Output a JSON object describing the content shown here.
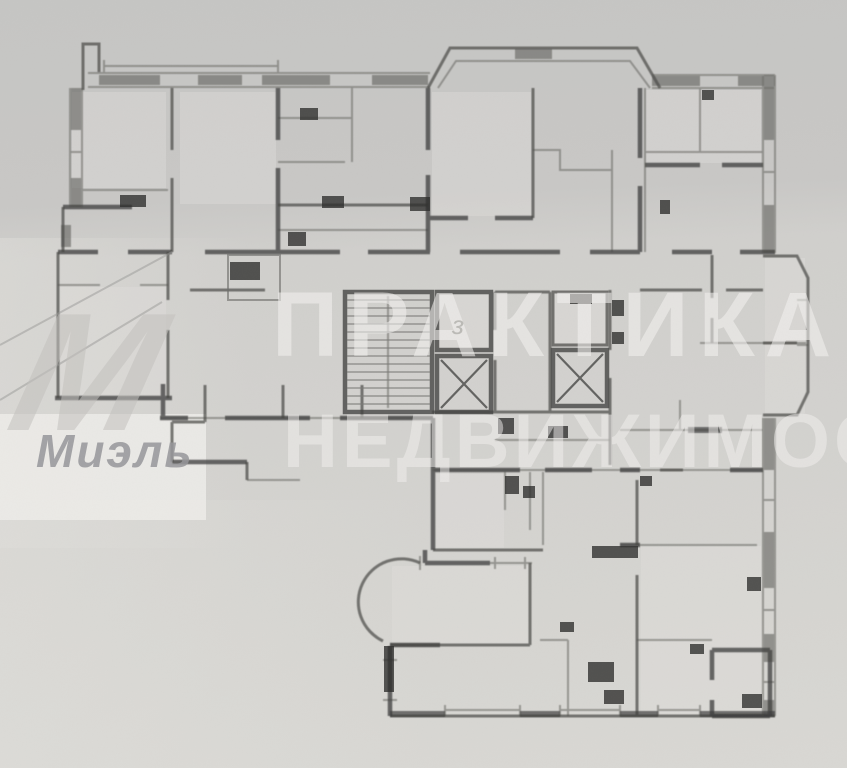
{
  "watermarks": {
    "practika": {
      "line1": "ПРАКТИКА",
      "line2": "НЕДВИЖИМОСТ",
      "color": "#f3f2ef"
    },
    "miel": {
      "name": "Миэль",
      "monogram": "М",
      "color": "#97979a"
    }
  },
  "plan": {
    "elevator_mark": "з",
    "wall_color": "#434341",
    "fixture_color": "#2d2d2b",
    "paper_color": "#d1d0cd"
  }
}
